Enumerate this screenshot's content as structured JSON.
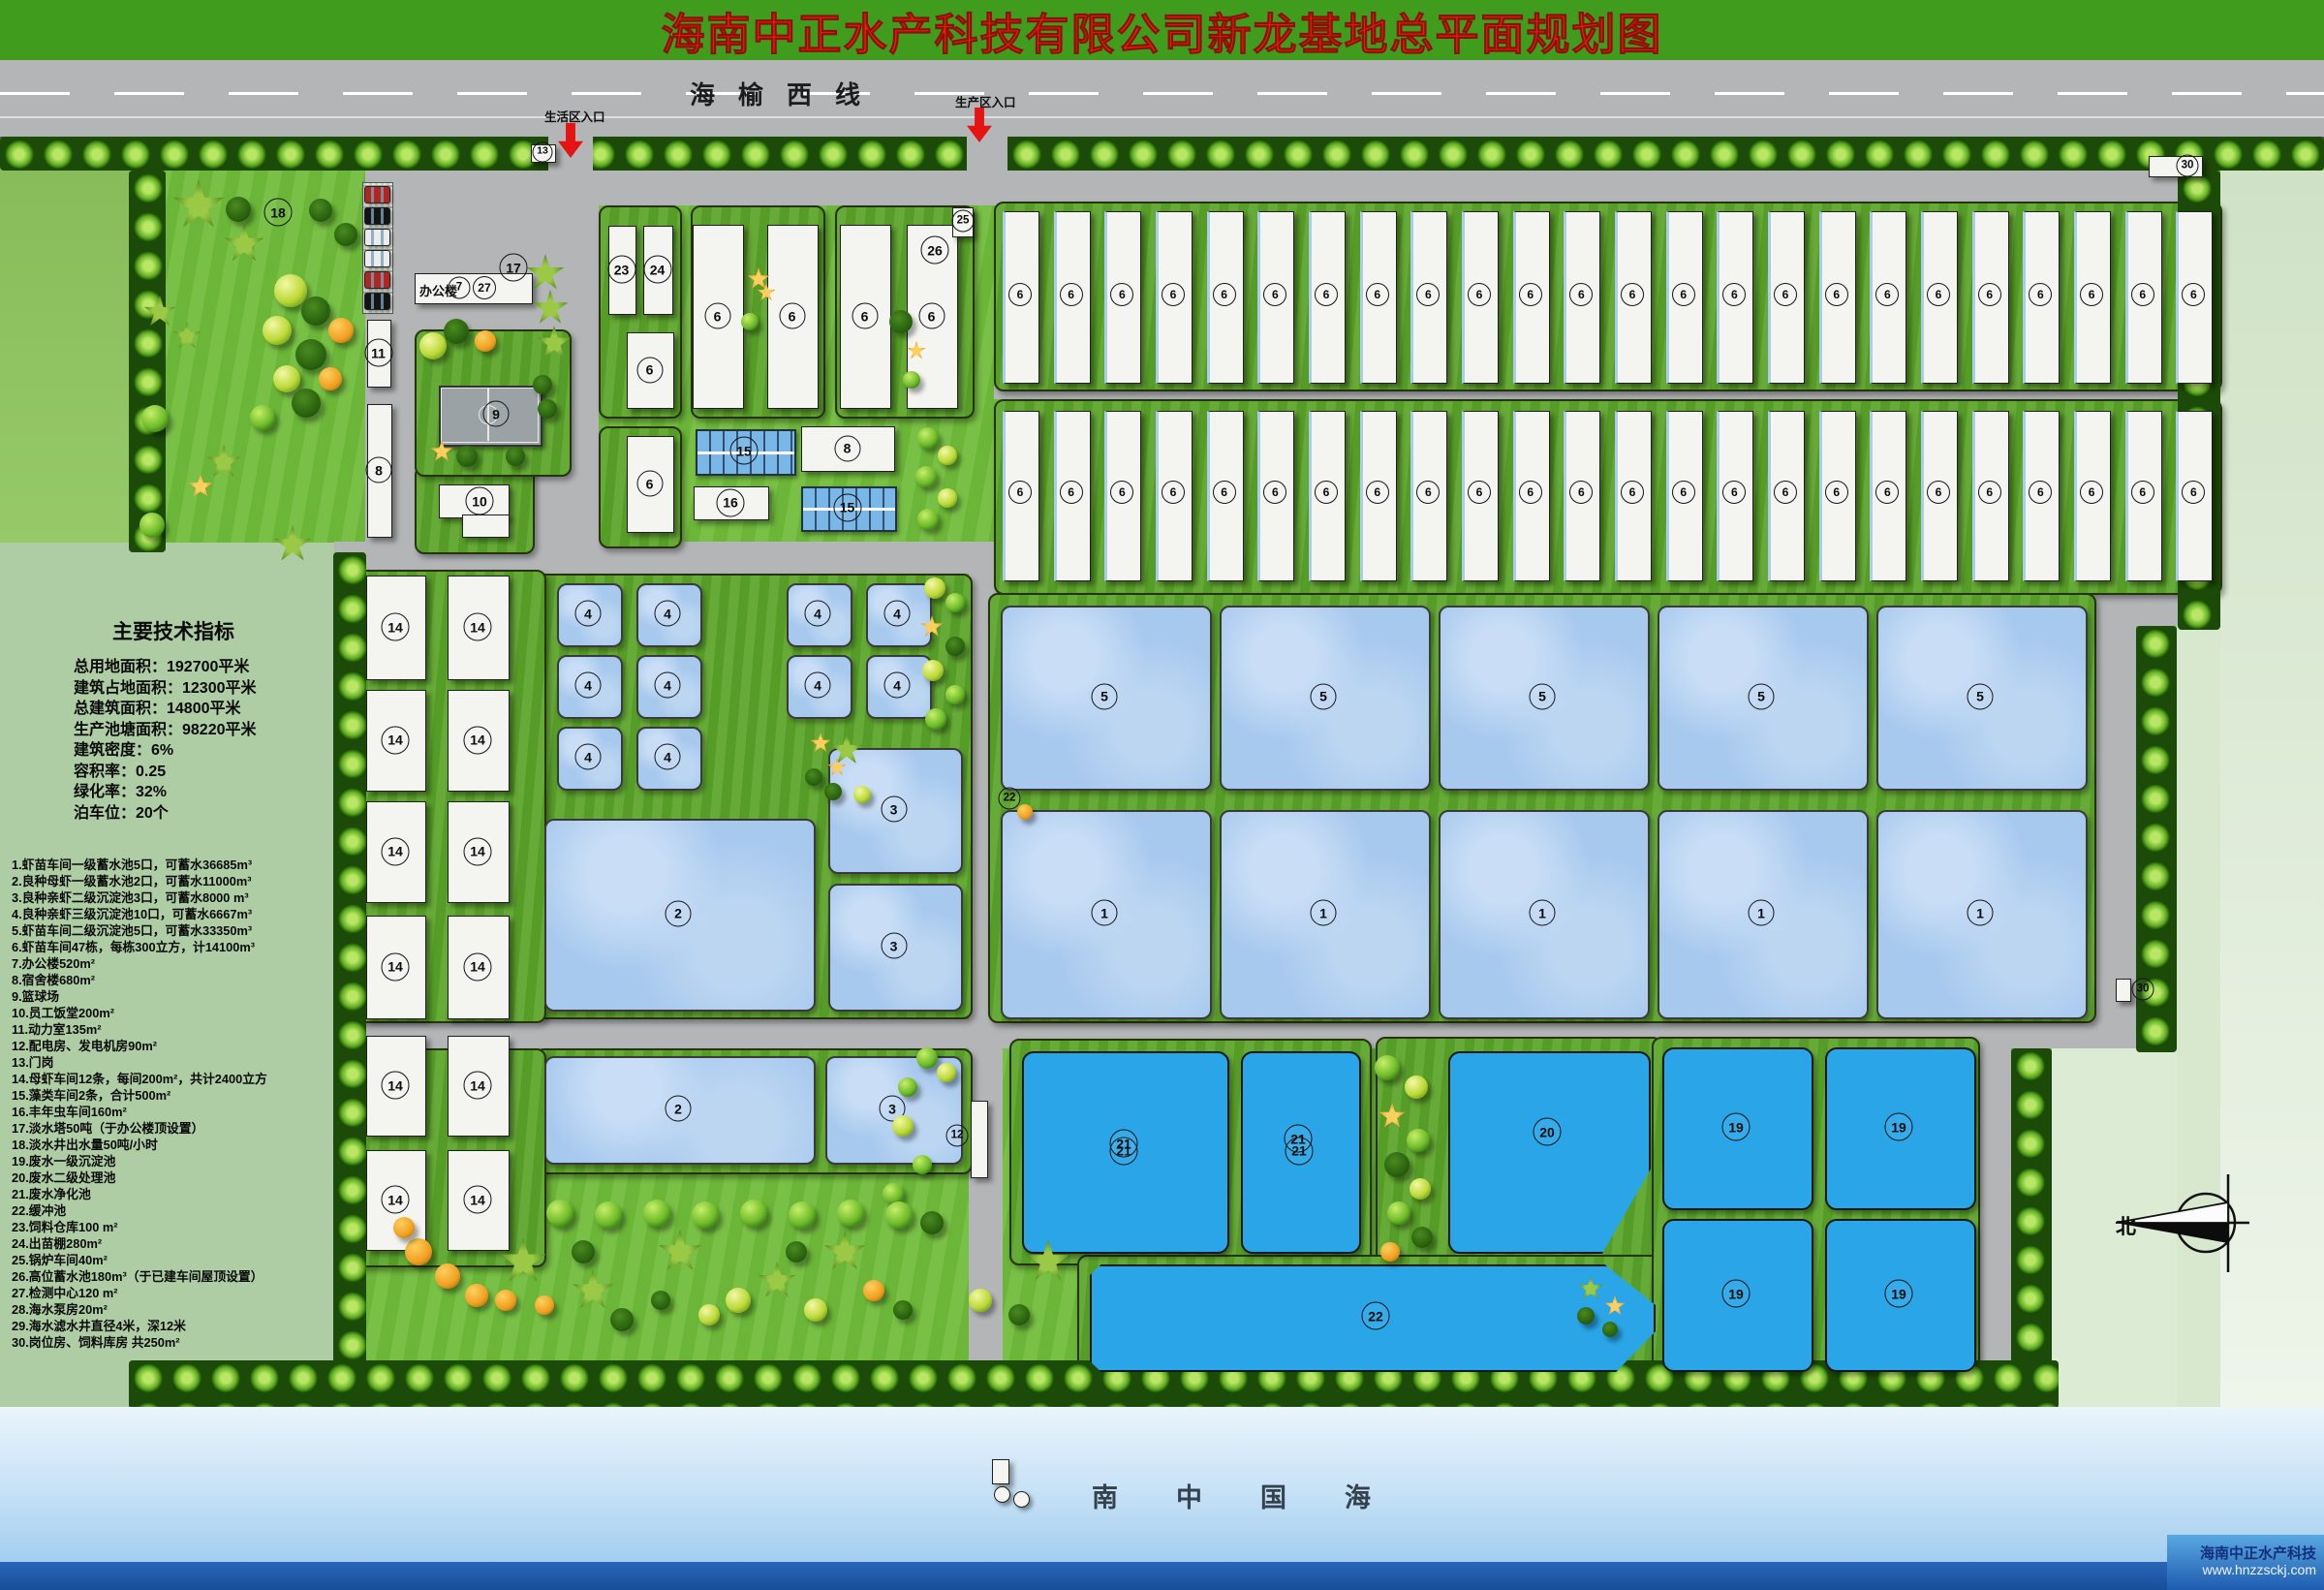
{
  "title": "海南中正水产科技有限公司新龙基地总平面规划图",
  "highway": {
    "name": "海榆西线"
  },
  "entrances": {
    "living": "生活区入口",
    "production": "生产区入口"
  },
  "sea": {
    "name": "南中国海"
  },
  "compass": {
    "north": "北"
  },
  "watermark": {
    "company": "海南中正水产科技",
    "url": "www.hnzzsckj.com"
  },
  "indicators": {
    "title": "主要技术指标",
    "lines": [
      "总用地面积：192700平米",
      "建筑占地面积：12300平米",
      "总建筑面积：14800平米",
      "生产池塘面积：98220平米",
      "建筑密度：6%",
      "容积率：0.25",
      "绿化率：32%",
      "泊车位：20个"
    ]
  },
  "legend": {
    "items": [
      "1.虾苗车间一级蓄水池5口，可蓄水36685m³",
      "2.良种母虾一级蓄水池2口，可蓄水11000m³",
      "3.良种亲虾二级沉淀池3口，可蓄水8000 m³",
      "4.良种亲虾三级沉淀池10口，可蓄水6667m³",
      "5.虾苗车间二级沉淀池5口，可蓄水33350m³",
      "6.虾苗车间47栋，每栋300立方，计14100m³",
      "7.办公楼520m²",
      "8.宿舍楼680m²",
      "9.篮球场",
      "10.员工饭堂200m²",
      "11.动力室135m²",
      "12.配电房、发电机房90m²",
      "13.门岗",
      "14.母虾车间12条，每间200m²，共计2400立方",
      "15.藻类车间2条，合计500m²",
      "16.丰年虫车间160m²",
      "17.淡水塔50吨（于办公楼顶设置）",
      "18.淡水井出水量50吨/小时",
      "19.废水一级沉淀池",
      "20.废水二级处理池",
      "21.废水净化池",
      "22.缓冲池",
      "23.饲料仓库100 m²",
      "24.出苗棚280m²",
      "25.锅炉车间40m²",
      "26.高位蓄水池180m³（于已建车间屋顶设置）",
      "27.检测中心120 m²",
      "28.海水泵房20m²",
      "29.海水滤水井直径4米，深12米",
      "30.岗位房、饲料库房 共250m²"
    ]
  },
  "plan": {
    "office_name": "办公楼",
    "numbers": [
      "1",
      "2",
      "3",
      "4",
      "5",
      "6",
      "7",
      "8",
      "9",
      "10",
      "11",
      "12",
      "13",
      "14",
      "15",
      "16",
      "17",
      "18",
      "19",
      "20",
      "21",
      "22",
      "23",
      "24",
      "25",
      "26",
      "27",
      "28",
      "29",
      "30"
    ]
  }
}
